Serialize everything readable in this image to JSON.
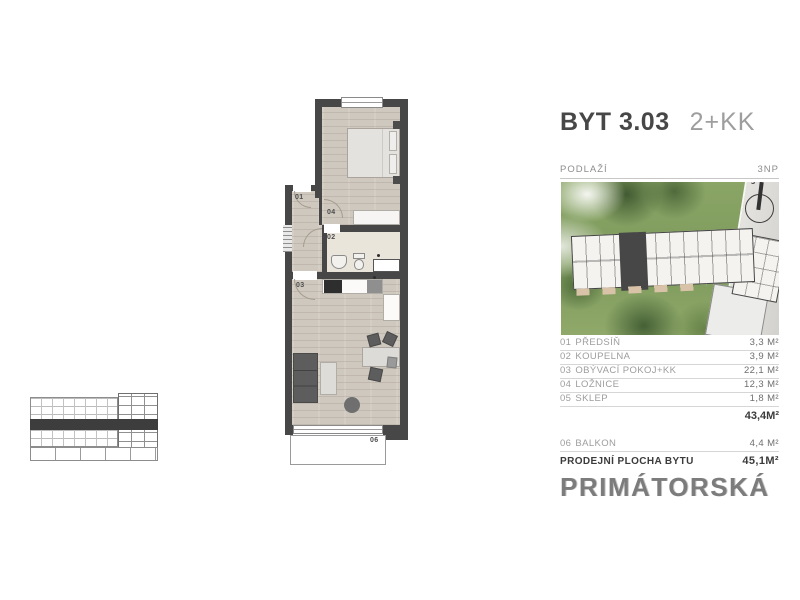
{
  "header": {
    "unit": "BYT 3.03",
    "disposition": "2+KK"
  },
  "floor": {
    "label": "PODLAŽÍ",
    "value": "3NP"
  },
  "site": {
    "compass": "S"
  },
  "plan": {
    "labels": {
      "hall": "01",
      "bath": "02",
      "living": "03",
      "bedroom": "04",
      "balcony": "06"
    }
  },
  "legend": {
    "rooms": [
      {
        "num": "01",
        "name": "PŘEDSÍŇ",
        "area": "3,3 M²"
      },
      {
        "num": "02",
        "name": "KOUPELNA",
        "area": "3,9 M²"
      },
      {
        "num": "03",
        "name": "OBÝVACÍ POKOJ+KK",
        "area": "22,1 M²"
      },
      {
        "num": "04",
        "name": "LOŽNICE",
        "area": "12,3 M²"
      },
      {
        "num": "05",
        "name": "SKLEP",
        "area": "1,8 M²"
      }
    ],
    "subtotal": "43,4M²",
    "extras": [
      {
        "num": "06",
        "name": "BALKON",
        "area": "4,4 M²"
      }
    ],
    "total_label": "PRODEJNÍ PLOCHA BYTU",
    "total_value": "45,1M²"
  },
  "brand": "PRIMÁTORSKÁ",
  "colors": {
    "wall": "#474747",
    "wood_floor": "#cfc8be",
    "bath_floor": "#eae5db",
    "unit_highlight": "#474747",
    "site_green": "#7d9a5c",
    "title_text": "#474747",
    "muted_text": "#9d9d9d",
    "brand_gray": "#7c7c7c"
  }
}
